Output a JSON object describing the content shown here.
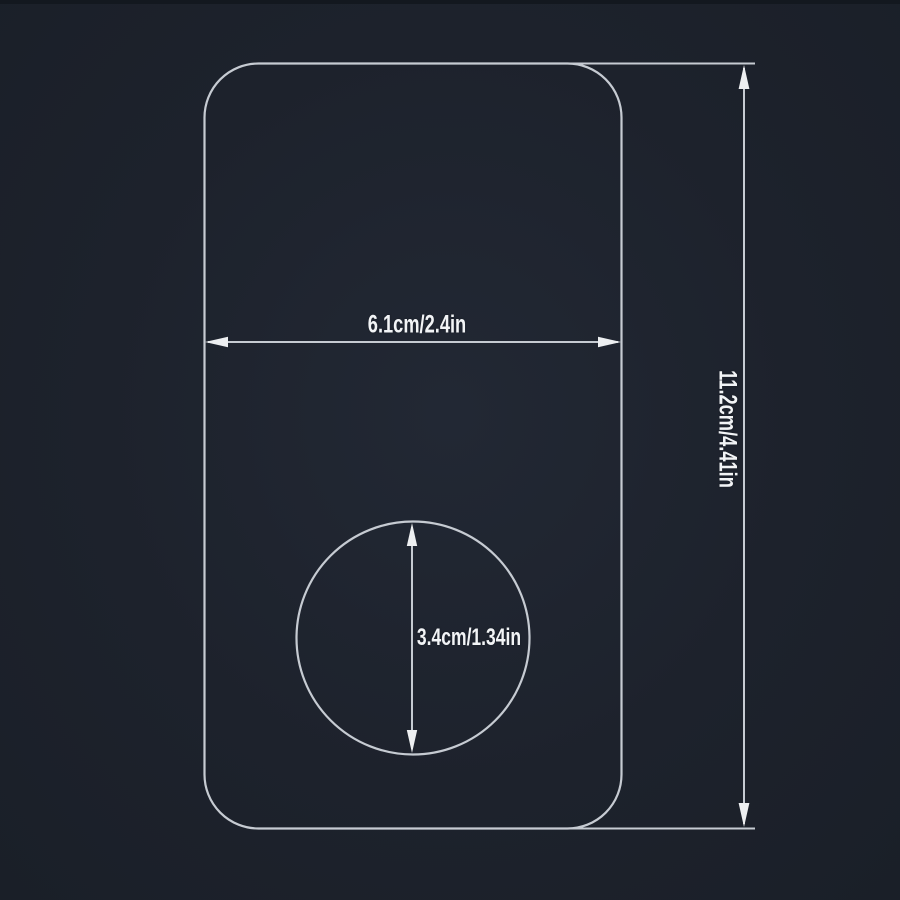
{
  "diagram": {
    "type": "product-dimension-drawing",
    "background_color": "#1d222c",
    "line_color": "#c6cbd2",
    "arrow_color": "#edeff1",
    "text_color": "#f2f4f6",
    "labels": {
      "width": "6.1cm/2.4in",
      "height": "11.2cm/4.41in",
      "circle_diameter": "3.4cm/1.34in"
    }
  }
}
